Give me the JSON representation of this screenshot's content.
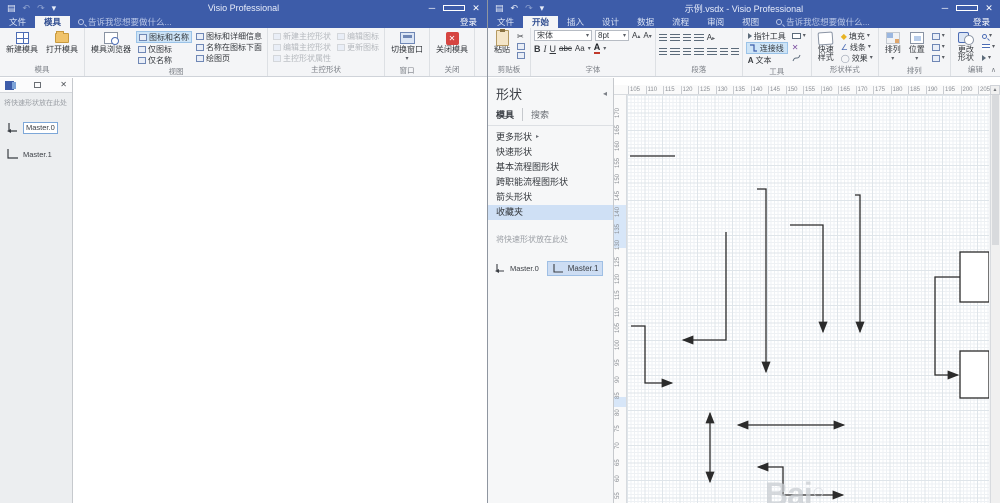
{
  "left_window": {
    "title": "Visio Professional",
    "qat": {
      "save": "▤",
      "undo": "↶",
      "redo": "↷",
      "more": "▾"
    },
    "tabs": {
      "file": "文件",
      "stencil": "模具"
    },
    "search_hint": "告诉我您想要做什么...",
    "signin": "登录",
    "window_buttons": {
      "min": "─",
      "close": "✕"
    },
    "ribbon": {
      "new_stencil": "新建模具",
      "open_stencil": "打开模具",
      "group_stencil": "模具",
      "stencil_explorer": "模具浏览器",
      "icon_and_name": "图标和名称",
      "icon_only": "仅图标",
      "name_only": "仅名称",
      "icon_details": "图标和详细信息",
      "name_under_icon": "名称在图标下面",
      "drawing_page": "绘图页",
      "group_view": "视图",
      "new_master": "新建主控形状",
      "edit_master": "编辑主控形状",
      "master_props": "主控形状属性",
      "edit_icon": "编辑图标",
      "update_icon": "更新图标",
      "group_master": "主控形状",
      "switch_window": "切换窗口",
      "group_window": "窗口",
      "close_stencil": "关闭模具",
      "group_close": "关闭"
    },
    "stencil_pane": {
      "hint": "将快速形状放在此处",
      "masters": [
        "Master.0",
        "Master.1"
      ]
    }
  },
  "right_window": {
    "title": "示例.vsdx - Visio Professional",
    "qat": {
      "save": "▤",
      "undo": "↶",
      "redo": "↷",
      "more": "▾"
    },
    "tabs": [
      "文件",
      "开始",
      "插入",
      "设计",
      "数据",
      "流程",
      "审阅",
      "视图"
    ],
    "search_hint": "告诉我您想要做什么...",
    "signin": "登录",
    "window_buttons": {
      "min": "─",
      "close": "✕"
    },
    "ribbon": {
      "paste": "粘贴",
      "cut": "✂",
      "group_clipboard": "剪贴板",
      "font_name": "宋体",
      "font_size": "8pt",
      "bold": "B",
      "italic": "I",
      "underline": "U",
      "strike": "abc",
      "case": "Aa",
      "font_color": "A",
      "group_font": "字体",
      "group_paragraph": "段落",
      "pointer_tool": "指针工具",
      "connector": "连接线",
      "text_tool": "文本",
      "group_tools": "工具",
      "quick_styles": "快速样式",
      "fill": "填充",
      "line": "线条",
      "effects": "效果",
      "group_shape_styles": "形状样式",
      "align": "排列",
      "position": "位置",
      "group_arrange": "排列",
      "change_shape": "更改形状",
      "group_editing": "编辑"
    },
    "shapes_panel": {
      "title": "形状",
      "tab_stencils": "模具",
      "tab_search": "搜索",
      "items": [
        "更多形状",
        "快速形状",
        "基本流程图形状",
        "跨职能流程图形状",
        "箭头形状",
        "收藏夹"
      ],
      "selected_item": "收藏夹",
      "hint": "将快速形状放在此处",
      "masters": [
        "Master.0",
        "Master.1"
      ],
      "selected_master": "Master.1"
    },
    "canvas": {
      "hruler": {
        "labels": [
          "105",
          "110",
          "115",
          "120",
          "125",
          "130",
          "135",
          "140",
          "145",
          "150",
          "155",
          "160",
          "165",
          "170",
          "175",
          "180",
          "185",
          "190",
          "195",
          "200",
          "205",
          "210"
        ],
        "start": 14,
        "step": 17.5
      },
      "vruler": {
        "labels": [
          "170",
          "165",
          "160",
          "155",
          "150",
          "145",
          "140",
          "135",
          "130",
          "125",
          "120",
          "115",
          "110",
          "105",
          "100",
          "95",
          "90",
          "85",
          "80",
          "75",
          "70",
          "65",
          "60",
          "55"
        ],
        "start": 23,
        "step": 16.55
      },
      "watermark": "Bai",
      "stroke_color": "#2b2b2b",
      "shapes": [
        {
          "name": "plain-line",
          "type": "polyline",
          "points": [
            [
              3,
              61
            ],
            [
              48,
              61
            ]
          ]
        },
        {
          "name": "elbow-arrow-down-1",
          "type": "polyline",
          "points": [
            [
              130,
              94
            ],
            [
              139,
              94
            ],
            [
              139,
              277
            ]
          ],
          "end": true
        },
        {
          "name": "elbow-arrow-left",
          "type": "polyline",
          "points": [
            [
              99,
              137
            ],
            [
              99,
              245
            ],
            [
              56,
              245
            ]
          ],
          "end": true
        },
        {
          "name": "elbow-arrow-right",
          "type": "polyline",
          "points": [
            [
              4,
              231
            ],
            [
              18,
              231
            ],
            [
              18,
              288
            ],
            [
              45,
              288
            ]
          ],
          "end": true
        },
        {
          "name": "vertical-double-arrow",
          "type": "polyline",
          "points": [
            [
              83,
              318
            ],
            [
              83,
              387
            ]
          ],
          "start": true,
          "end": true
        },
        {
          "name": "horizontal-double-arrow",
          "type": "polyline",
          "points": [
            [
              111,
              330
            ],
            [
              217,
              330
            ]
          ],
          "start": true,
          "end": true
        },
        {
          "name": "elbow-double-arrow-bottom",
          "type": "polyline",
          "points": [
            [
              131,
              372
            ],
            [
              156,
              372
            ],
            [
              156,
              400
            ],
            [
              216,
              400
            ]
          ],
          "start": true,
          "end": true
        },
        {
          "name": "elbow-arrow-down-2",
          "type": "polyline",
          "points": [
            [
              163,
              130
            ],
            [
              196,
              130
            ],
            [
              196,
              237
            ]
          ],
          "end": true
        },
        {
          "name": "vertical-arrow-down",
          "type": "polyline",
          "points": [
            [
              228,
              100
            ],
            [
              233,
              100
            ],
            [
              233,
              237
            ]
          ],
          "end": true
        },
        {
          "name": "connector-to-box",
          "type": "polyline",
          "points": [
            [
              333,
              182
            ],
            [
              308,
              182
            ],
            [
              308,
              280
            ],
            [
              331,
              280
            ]
          ],
          "end": true
        },
        {
          "name": "box-1",
          "type": "rect",
          "x": 333,
          "y": 157,
          "w": 29,
          "h": 50
        },
        {
          "name": "box-2",
          "type": "rect",
          "x": 333,
          "y": 256,
          "w": 29,
          "h": 47
        }
      ]
    }
  }
}
